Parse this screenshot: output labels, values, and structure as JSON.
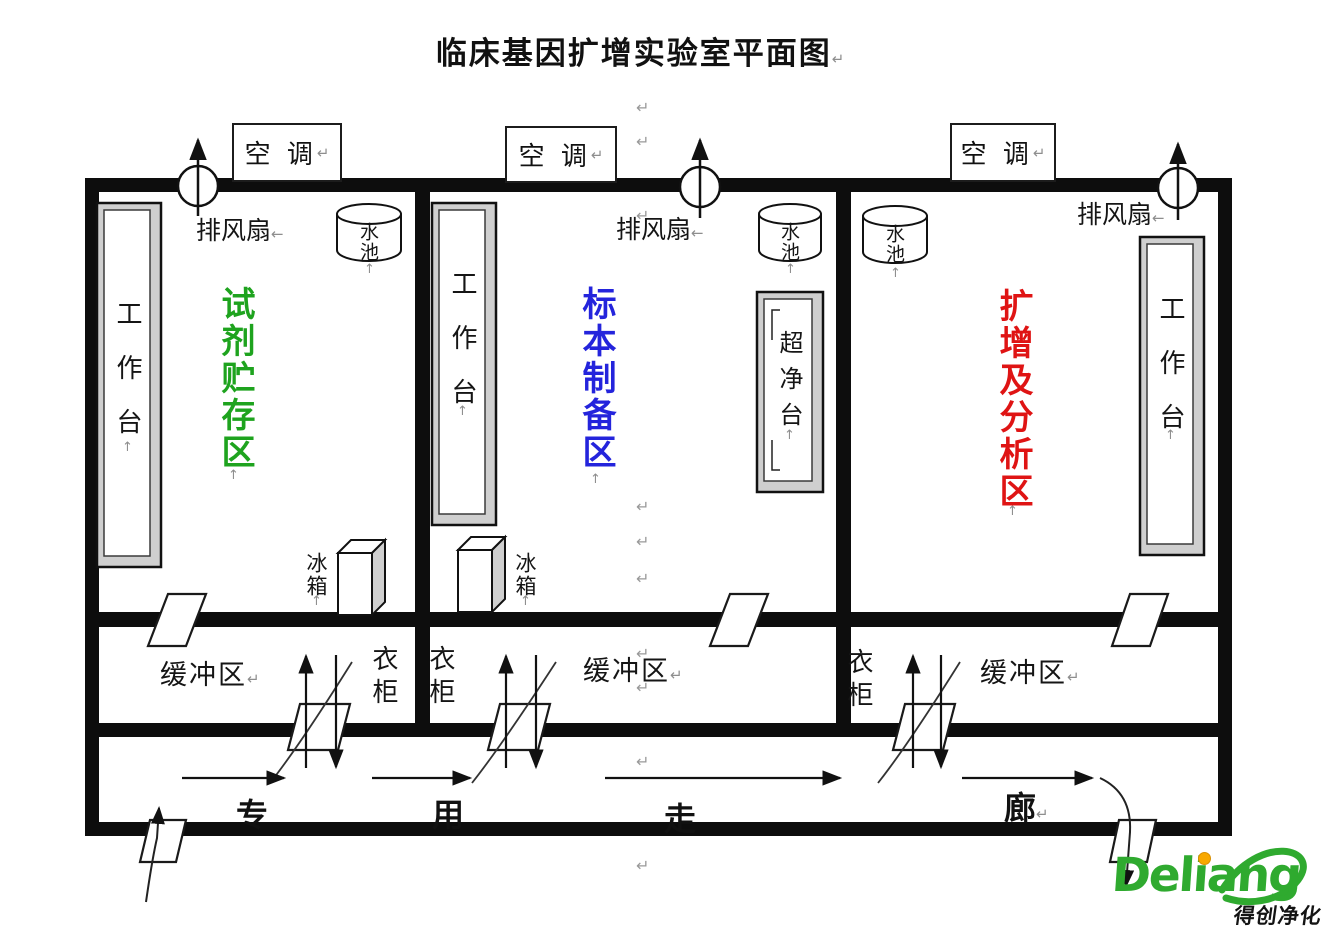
{
  "title": "临床基因扩增实验室平面图",
  "marks": {
    "return": "↵",
    "left": "←",
    "up": "↑"
  },
  "zones": {
    "reagent": {
      "label": "试剂贮存区",
      "color": "#1ea31e"
    },
    "specimen": {
      "label": "标本制备区",
      "color": "#2424dc"
    },
    "amplification": {
      "label": "扩增及分析区",
      "color": "#df1414"
    }
  },
  "fixtures": {
    "air_conditioner": "空 调",
    "exhaust_fan": "排风扇",
    "sink": "水池",
    "workbench": "工作台",
    "clean_bench": "超净台",
    "fridge": "冰箱",
    "wardrobe": "衣柜",
    "buffer_zone": "缓冲区"
  },
  "corridor": {
    "chars": [
      "专",
      "用",
      "走",
      "廊"
    ]
  },
  "logo": {
    "brand": "Deliang",
    "caption": "得创净化",
    "colors": {
      "green": "#2faa2f",
      "orange": "#f8a800"
    }
  }
}
